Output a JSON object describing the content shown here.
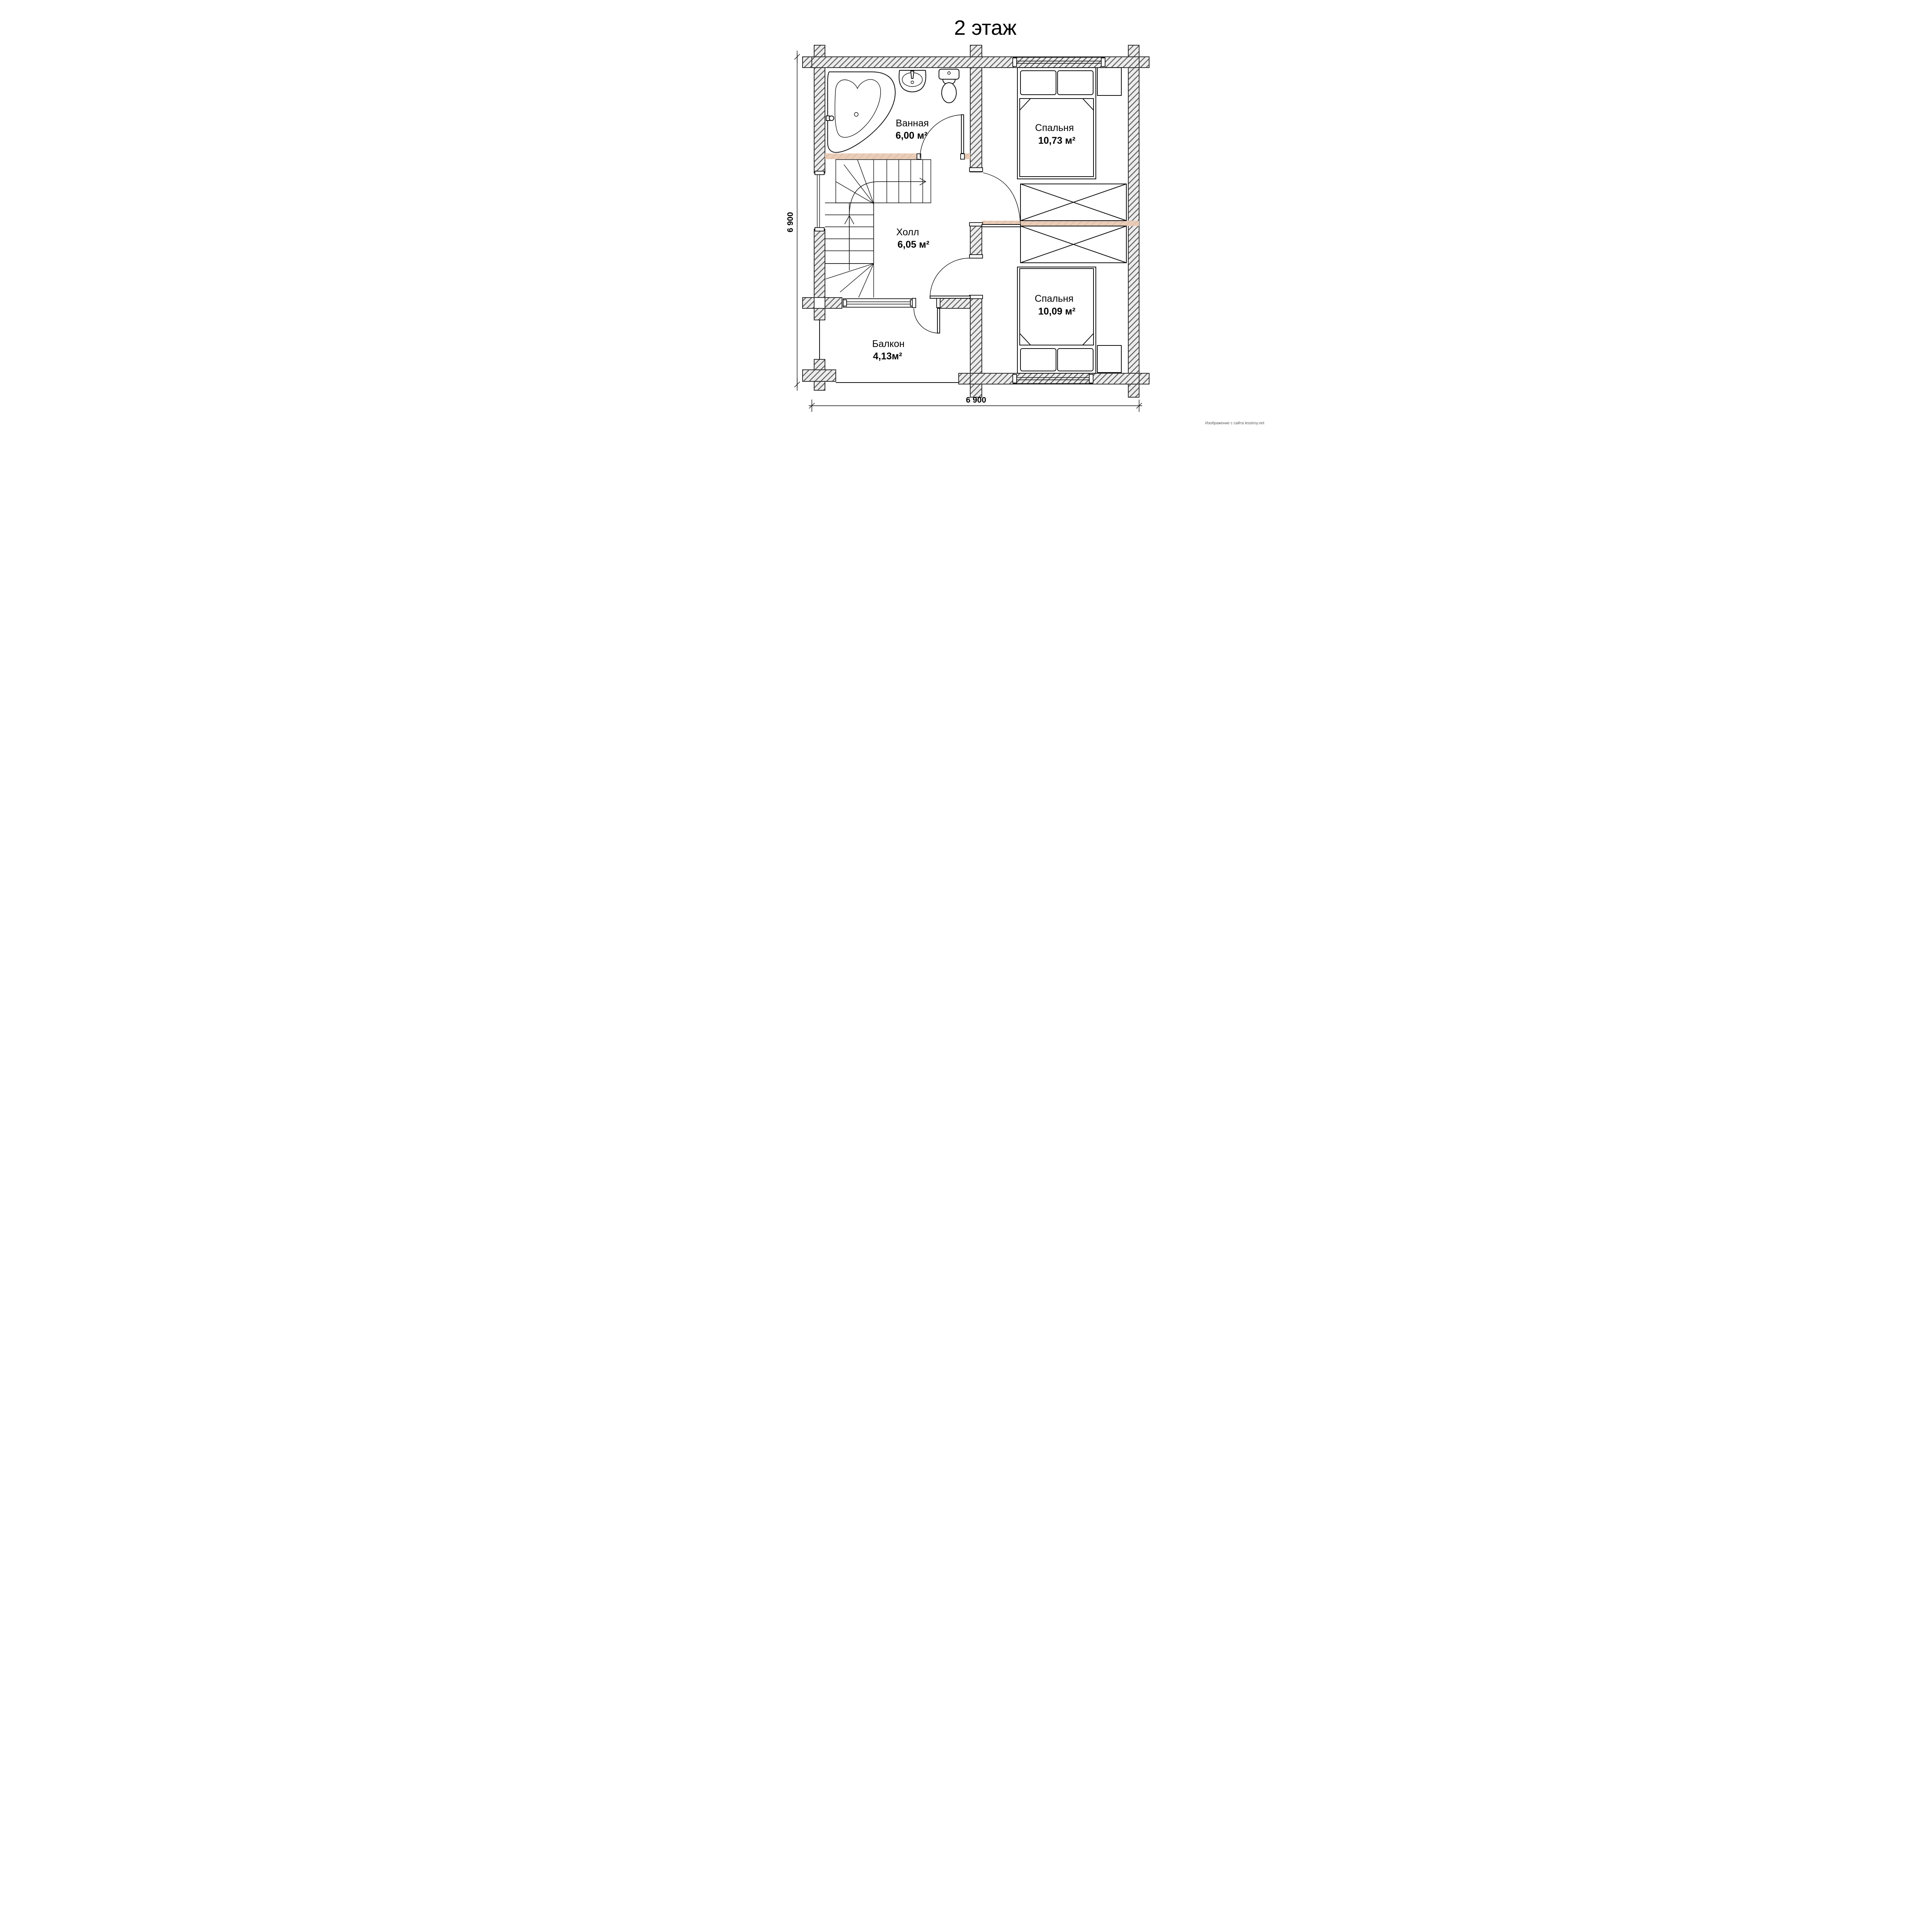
{
  "page": {
    "title": "2 этаж",
    "watermark": "Изображение с сайта lesstroy.net"
  },
  "plan_type": "floor-plan",
  "rooms": {
    "bathroom": {
      "name": "Ванная",
      "area": "6,00 м²"
    },
    "bedroom1": {
      "name": "Спальня",
      "area": "10,73 м²"
    },
    "hall": {
      "name": "Холл",
      "area": "6,05 м²"
    },
    "bedroom2": {
      "name": "Спальня",
      "area": "10,09 м²"
    },
    "balcony": {
      "name": "Балкон",
      "area": "4,13м²"
    }
  },
  "dimensions": {
    "left_total": "6 900",
    "bottom_total": "6 900"
  },
  "fixtures": [
    "corner-bathtub",
    "pedestal-sink",
    "toilet",
    "winder-staircase",
    "double-bed",
    "double-bed",
    "wardrobe",
    "wardrobe",
    "nightstand",
    "nightstand"
  ],
  "colors": {
    "wall_fill": "#ececec",
    "wall_hatch": "#5f5f5f",
    "wall_line": "#2e2e2e",
    "beam_fill": "#e9cdb9",
    "beam_hatch": "#d8b39c",
    "ink": "#0f0f0f",
    "watermark": "#555555"
  }
}
